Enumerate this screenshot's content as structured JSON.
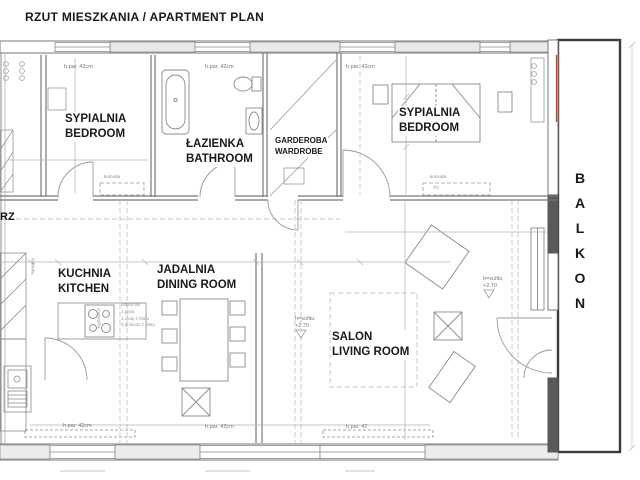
{
  "title": "RZUT MIESZKANIA / APARTMENT PLAN",
  "rooms": {
    "bedroom_left": {
      "pl": "SYPIALNIA",
      "en": "BEDROOM"
    },
    "bathroom": {
      "pl": "ŁAZIENKA",
      "en": "BATHROOM"
    },
    "wardrobe": {
      "pl": "GARDEROBA",
      "en": "WARDROBE"
    },
    "bedroom_right": {
      "pl": "SYPIALNIA",
      "en": "BEDROOM"
    },
    "kitchen": {
      "pl": "KUCHNIA",
      "en": "KITCHEN"
    },
    "dining_room": {
      "pl": "JADALNIA",
      "en": "DINING ROOM"
    },
    "living_room": {
      "pl": "SALON",
      "en": "LIVING ROOM"
    },
    "balcony": {
      "pl": "BALKON"
    }
  },
  "annotations": {
    "corridor_partial": "RZ",
    "window_sill_height": "h.par. 42cm",
    "window_sill_height_short": "h.par. 42",
    "ceiling_height_label": "h=sufitu",
    "ceiling_height_value": "+2.70",
    "dresser": "komoda",
    "tv": "TV",
    "fridge": "lodówka",
    "dishwasher": "zmywarka",
    "kitchen_notes": {
      "header": "odbiorniki:",
      "item1": "1.płyta",
      "item2": "2.okap z blatu",
      "item3": "3.gniazdo z blatu"
    }
  },
  "colors": {
    "paper": "#ffffff",
    "line": "#999999",
    "wall": "#444444",
    "text": "#1a1a1a",
    "accent_red": "#b0472f"
  }
}
